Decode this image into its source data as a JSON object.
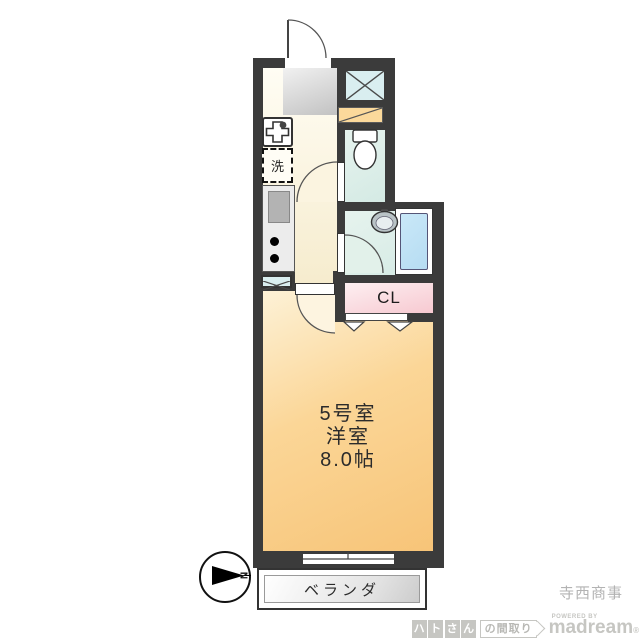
{
  "plan": {
    "room_label": {
      "line1": "5号室",
      "line2": "洋室",
      "line3": "8.0帖"
    },
    "closet_label": "CL",
    "washer_label": "洗",
    "balcony_label": "ベランダ",
    "compass_letter": "N"
  },
  "footer": {
    "company": "寺西商事",
    "logo": {
      "chars": [
        "ハ",
        "ト",
        "さ",
        "ん"
      ],
      "suffix": "の間取り",
      "powered_by": "POWERED BY",
      "brand": "madream",
      "reg": "®"
    }
  },
  "colors": {
    "wall": "#3b3b3b",
    "corridor2": "#f6ecce",
    "orange3": "#f7c478",
    "mint2": "#d4eae4",
    "bathblue2": "#b6dcf2",
    "pink2": "#f7c9d1",
    "shoebox": "#fbd99b",
    "shaft": "#d9eef0",
    "genkan2": "#c2c2c2",
    "logo_gray": "#c6c6c2",
    "company_gray": "#b3b3b3"
  }
}
